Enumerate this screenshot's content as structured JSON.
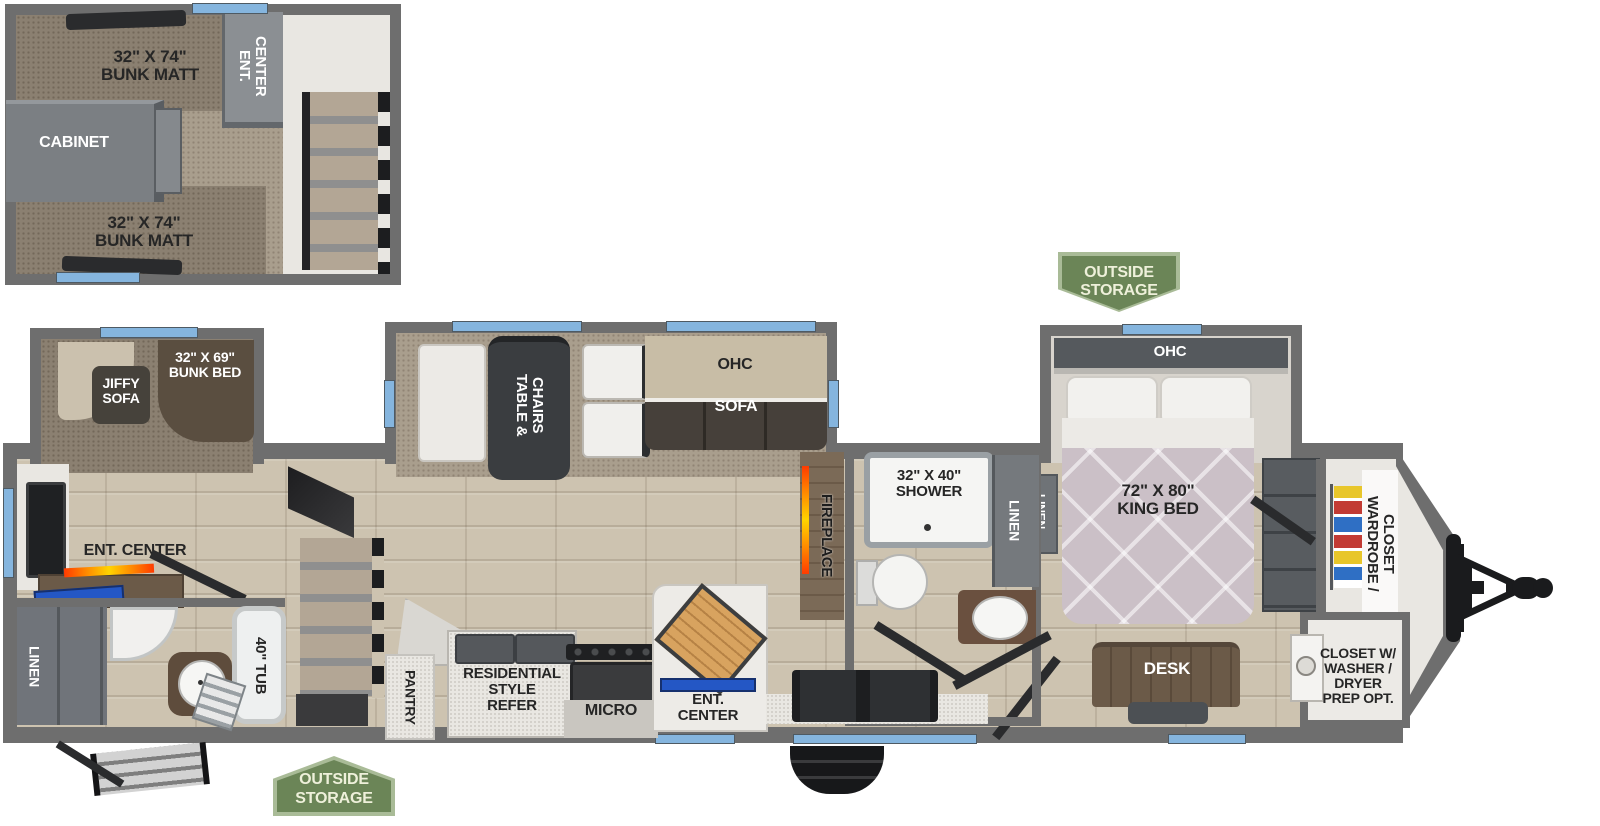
{
  "floorplan": {
    "loft": {
      "bunk_top": "32\" X 74\"\nBUNK MATT",
      "ent_center": "ENT.\nCENTER",
      "cabinet": "CABINET",
      "bunk_bottom": "32\" X 74\"\nBUNK MATT"
    },
    "bunk_room": {
      "jiffy_sofa": "JIFFY\nSOFA",
      "bunk_bed": "32\" X 69\"\nBUNK BED"
    },
    "rear": {
      "ent_center": "ENT. CENTER",
      "linen": "LINEN",
      "tub": "40\" TUB"
    },
    "kitchen": {
      "pantry": "PANTRY",
      "refer": "RESIDENTIAL\nSTYLE\nREFER",
      "micro": "MICRO",
      "ent_center": "ENT.\nCENTER"
    },
    "dinette": {
      "table": "TABLE &\nCHAIRS",
      "ohc": "OHC",
      "sofa": "SOFA"
    },
    "living": {
      "fireplace": "FIREPLACE"
    },
    "bath": {
      "shower": "32\" X 40\"\nSHOWER",
      "linen": "LINEN"
    },
    "bedroom": {
      "ohc": "OHC",
      "king_bed": "72\" X 80\"\nKING BED",
      "linen": "LINEN",
      "desk": "DESK"
    },
    "front": {
      "wardrobe": "WARDROBE /\nCLOSET",
      "closet_washer": "CLOSET W/\nWASHER /\nDRYER\nPREP OPT."
    },
    "badges": {
      "outside_storage_top": "OUTSIDE\nSTORAGE",
      "outside_storage_bottom": "OUTSIDE\nSTORAGE"
    },
    "colors": {
      "wall_gray": "#6e6e6e",
      "window_blue": "#85b5de",
      "badge_green": "#6b8557",
      "badge_border": "#a9bb97",
      "flame_orange": "#ff8a00",
      "shelf_blue": "#2457c5",
      "mattress": "#cbc0c7",
      "wood_floor": "#cdc3b0"
    }
  }
}
